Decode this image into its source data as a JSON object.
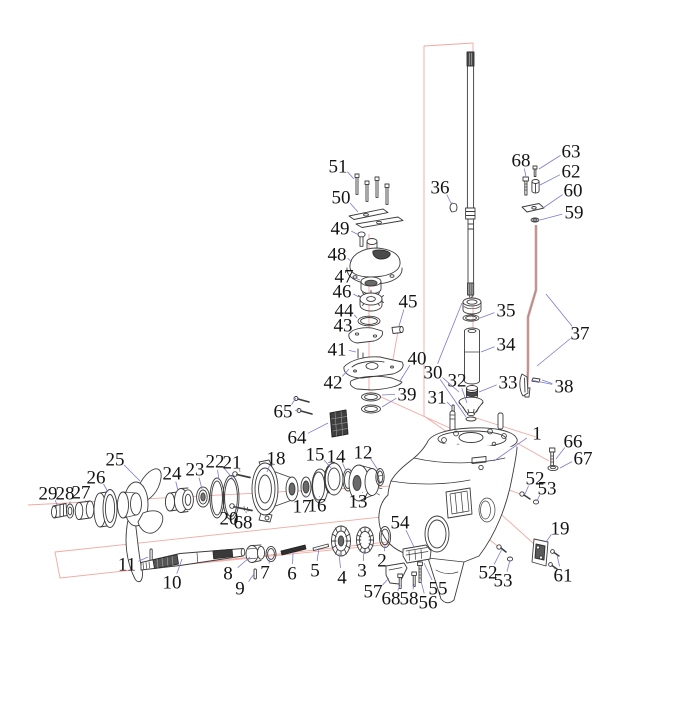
{
  "diagram": {
    "title": "outboard-lower-unit-exploded-parts-diagram",
    "type": "exploded-view",
    "colors": {
      "background": "#ffffff",
      "part_line": "#3c3c3c",
      "leader": "#7b7bcd",
      "construction": "#f0a9a3",
      "label_text": "#141414",
      "dark_fill": "#4a4a4a"
    },
    "labels": [
      {
        "text": "51",
        "x": 338,
        "y": 166,
        "leaders": [
          [
            354,
            179
          ]
        ]
      },
      {
        "text": "50",
        "x": 341,
        "y": 197,
        "leaders": [
          [
            358,
            212
          ]
        ]
      },
      {
        "text": "49",
        "x": 340,
        "y": 228,
        "leaders": [
          [
            359,
            235
          ]
        ]
      },
      {
        "text": "48",
        "x": 337,
        "y": 254,
        "leaders": [
          [
            352,
            262
          ]
        ]
      },
      {
        "text": "47",
        "x": 344,
        "y": 276,
        "leaders": [
          [
            360,
            280
          ]
        ]
      },
      {
        "text": "46",
        "x": 342,
        "y": 291,
        "leaders": [
          [
            359,
            297
          ]
        ]
      },
      {
        "text": "44",
        "x": 344,
        "y": 310,
        "leaders": [
          [
            357,
            318
          ]
        ]
      },
      {
        "text": "43",
        "x": 343,
        "y": 325,
        "leaders": [
          [
            351,
            333
          ]
        ]
      },
      {
        "text": "41",
        "x": 337,
        "y": 349,
        "leaders": [
          [
            356,
            352
          ]
        ]
      },
      {
        "text": "42",
        "x": 333,
        "y": 382,
        "leaders": [
          [
            349,
            369
          ]
        ]
      },
      {
        "text": "45",
        "x": 408,
        "y": 301,
        "leaders": [
          [
            399,
            326
          ]
        ]
      },
      {
        "text": "40",
        "x": 417,
        "y": 358,
        "leaders": [
          [
            400,
            381
          ]
        ]
      },
      {
        "text": "39",
        "x": 407,
        "y": 394,
        "leaders": [
          [
            382,
            395
          ],
          [
            382,
            407
          ]
        ]
      },
      {
        "text": "65",
        "x": 283,
        "y": 411,
        "leaders": [
          [
            296,
            398
          ],
          [
            299,
            410
          ]
        ]
      },
      {
        "text": "64",
        "x": 297,
        "y": 437,
        "leaders": [
          [
            328,
            423
          ]
        ]
      },
      {
        "text": "36",
        "x": 440,
        "y": 187,
        "leaders": [
          [
            452,
            205
          ]
        ]
      },
      {
        "text": "68",
        "x": 521,
        "y": 160,
        "leaders": [
          [
            526,
            177
          ]
        ]
      },
      {
        "text": "63",
        "x": 571,
        "y": 151,
        "leaders": [
          [
            539,
            169
          ]
        ]
      },
      {
        "text": "62",
        "x": 571,
        "y": 171,
        "leaders": [
          [
            540,
            185
          ]
        ]
      },
      {
        "text": "60",
        "x": 573,
        "y": 190,
        "leaders": [
          [
            543,
            208
          ]
        ]
      },
      {
        "text": "59",
        "x": 574,
        "y": 212,
        "leaders": [
          [
            540,
            220
          ]
        ]
      },
      {
        "text": "35",
        "x": 506,
        "y": 310,
        "leaders": [
          [
            480,
            318
          ]
        ]
      },
      {
        "text": "34",
        "x": 506,
        "y": 344,
        "leaders": [
          [
            481,
            352
          ]
        ]
      },
      {
        "text": "37",
        "x": 580,
        "y": 333,
        "leaders": [
          [
            546,
            294
          ],
          [
            537,
            366
          ]
        ]
      },
      {
        "text": "30",
        "x": 433,
        "y": 372,
        "leaders": [
          [
            462,
            303
          ],
          [
            459,
            392
          ],
          [
            466,
            417
          ]
        ]
      },
      {
        "text": "32",
        "x": 457,
        "y": 380,
        "leaders": [
          [
            467,
            403
          ]
        ]
      },
      {
        "text": "33",
        "x": 508,
        "y": 382,
        "leaders": [
          [
            479,
            392
          ]
        ]
      },
      {
        "text": "38",
        "x": 564,
        "y": 386,
        "leaders": [
          [
            531,
            380
          ],
          [
            542,
            380
          ]
        ]
      },
      {
        "text": "31",
        "x": 437,
        "y": 397,
        "leaders": [
          [
            452,
            407
          ]
        ]
      },
      {
        "text": "1",
        "x": 537,
        "y": 433,
        "leaders": [
          [
            494,
            461
          ]
        ]
      },
      {
        "text": "66",
        "x": 573,
        "y": 441,
        "leaders": [
          [
            556,
            459
          ]
        ]
      },
      {
        "text": "67",
        "x": 583,
        "y": 458,
        "leaders": [
          [
            560,
            468
          ]
        ]
      },
      {
        "text": "25",
        "x": 115,
        "y": 459,
        "leaders": [
          [
            140,
            481
          ]
        ]
      },
      {
        "text": "26",
        "x": 96,
        "y": 477,
        "leaders": [
          [
            108,
            492
          ]
        ]
      },
      {
        "text": "22",
        "x": 215,
        "y": 461,
        "leaders": [
          [
            219,
            480
          ],
          [
            233,
            479
          ]
        ]
      },
      {
        "text": "21",
        "x": 232,
        "y": 462,
        "leaders": [
          [
            240,
            472
          ]
        ]
      },
      {
        "text": "23",
        "x": 195,
        "y": 469,
        "leaders": [
          [
            202,
            489
          ]
        ]
      },
      {
        "text": "24",
        "x": 172,
        "y": 473,
        "leaders": [
          [
            178,
            491
          ]
        ]
      },
      {
        "text": "18",
        "x": 276,
        "y": 458,
        "leaders": [
          [
            267,
            472
          ]
        ]
      },
      {
        "text": "15",
        "x": 315,
        "y": 454,
        "leaders": [
          [
            331,
            468
          ]
        ]
      },
      {
        "text": "14",
        "x": 336,
        "y": 456,
        "leaders": [
          [
            346,
            471
          ]
        ]
      },
      {
        "text": "12",
        "x": 363,
        "y": 452,
        "leaders": [
          [
            378,
            470
          ]
        ]
      },
      {
        "text": "29",
        "x": 48,
        "y": 493,
        "leaders": [
          [
            57,
            505
          ]
        ]
      },
      {
        "text": "28",
        "x": 65,
        "y": 493,
        "leaders": [
          [
            70,
            504
          ]
        ]
      },
      {
        "text": "27",
        "x": 81,
        "y": 492,
        "leaders": [
          [
            85,
            502
          ]
        ]
      },
      {
        "text": "17",
        "x": 302,
        "y": 506,
        "leaders": [
          [
            305,
            495
          ]
        ]
      },
      {
        "text": "16",
        "x": 317,
        "y": 505,
        "leaders": [
          [
            319,
            497
          ]
        ]
      },
      {
        "text": "13",
        "x": 358,
        "y": 501,
        "leaders": [
          [
            362,
            492
          ]
        ]
      },
      {
        "text": "20",
        "x": 229,
        "y": 518,
        "leaders": [
          [
            236,
            507
          ]
        ]
      },
      {
        "text": "68",
        "x": 243,
        "y": 522,
        "leaders": [
          [
            246,
            511
          ]
        ]
      },
      {
        "text": "52",
        "x": 535,
        "y": 478,
        "leaders": [
          [
            525,
            494
          ]
        ]
      },
      {
        "text": "53",
        "x": 547,
        "y": 488,
        "leaders": [
          [
            537,
            501
          ]
        ]
      },
      {
        "text": "54",
        "x": 400,
        "y": 522,
        "leaders": [
          [
            414,
            547
          ]
        ]
      },
      {
        "text": "19",
        "x": 560,
        "y": 528,
        "leaders": [
          [
            546,
            542
          ]
        ]
      },
      {
        "text": "11",
        "x": 127,
        "y": 564,
        "leaders": [
          [
            148,
            557
          ]
        ]
      },
      {
        "text": "10",
        "x": 172,
        "y": 582,
        "leaders": [
          [
            182,
            559
          ]
        ]
      },
      {
        "text": "8",
        "x": 228,
        "y": 573,
        "leaders": [
          [
            250,
            557
          ]
        ]
      },
      {
        "text": "9",
        "x": 240,
        "y": 588,
        "leaders": [
          [
            254,
            574
          ]
        ]
      },
      {
        "text": "7",
        "x": 265,
        "y": 572,
        "leaders": [
          [
            270,
            558
          ]
        ]
      },
      {
        "text": "6",
        "x": 292,
        "y": 573,
        "leaders": [
          [
            293,
            552
          ]
        ]
      },
      {
        "text": "5",
        "x": 315,
        "y": 570,
        "leaders": [
          [
            319,
            548
          ]
        ]
      },
      {
        "text": "4",
        "x": 342,
        "y": 577,
        "leaders": [
          [
            339,
            553
          ]
        ]
      },
      {
        "text": "3",
        "x": 362,
        "y": 570,
        "leaders": [
          [
            364,
            551
          ]
        ]
      },
      {
        "text": "2",
        "x": 382,
        "y": 560,
        "leaders": [
          [
            385,
            545
          ]
        ]
      },
      {
        "text": "57",
        "x": 373,
        "y": 591,
        "leaders": [
          [
            389,
            578
          ]
        ]
      },
      {
        "text": "68",
        "x": 391,
        "y": 598,
        "leaders": [
          [
            400,
            585
          ]
        ]
      },
      {
        "text": "58",
        "x": 409,
        "y": 598,
        "leaders": [
          [
            414,
            584
          ]
        ]
      },
      {
        "text": "56",
        "x": 428,
        "y": 602,
        "leaders": [
          [
            421,
            581
          ]
        ]
      },
      {
        "text": "55",
        "x": 438,
        "y": 588,
        "leaders": [
          [
            424,
            563
          ]
        ]
      },
      {
        "text": "52",
        "x": 488,
        "y": 572,
        "leaders": [
          [
            502,
            549
          ]
        ]
      },
      {
        "text": "53",
        "x": 503,
        "y": 580,
        "leaders": [
          [
            510,
            560
          ]
        ]
      },
      {
        "text": "61",
        "x": 563,
        "y": 575,
        "leaders": [
          [
            557,
            555
          ],
          [
            555,
            568
          ]
        ]
      }
    ]
  }
}
